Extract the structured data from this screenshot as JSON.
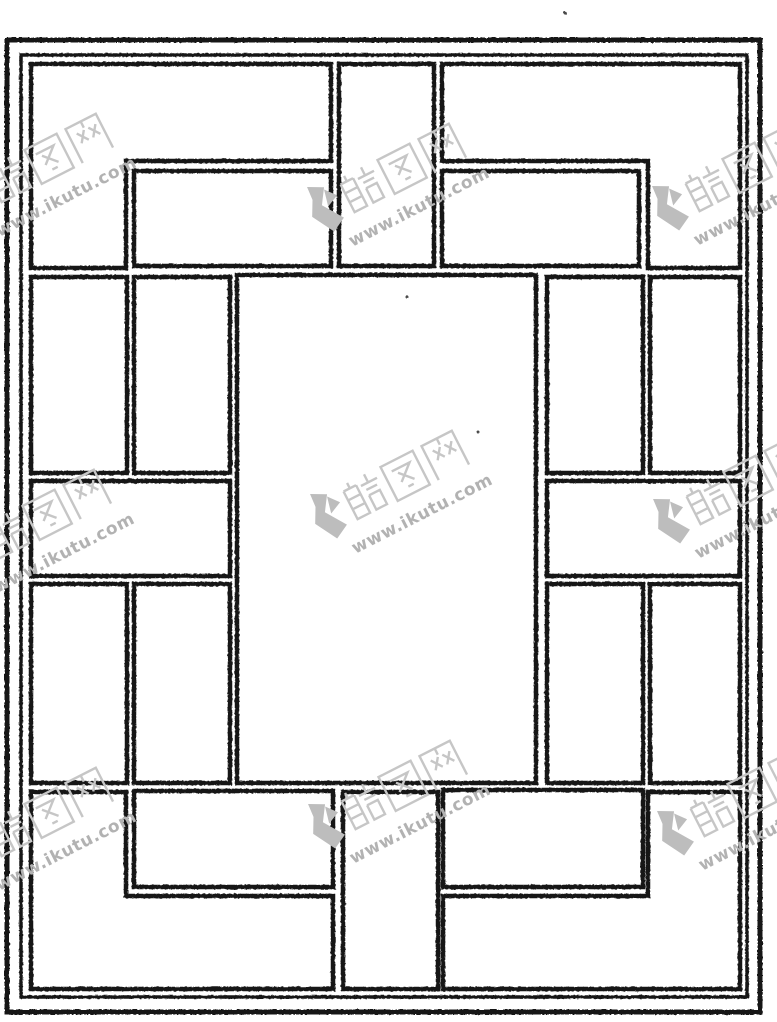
{
  "image": {
    "kind": "scanned line drawing of a traditional Chinese lattice window grille pattern",
    "width": 777,
    "height": 1022,
    "background_color": "#ffffff",
    "ink_color": "#191919"
  },
  "drawing": {
    "panel_stroke": 4.5,
    "borders": [
      {
        "x": 7,
        "y": 40,
        "w": 753,
        "h": 972,
        "stroke": 5
      },
      {
        "x": 21,
        "y": 55,
        "w": 726,
        "h": 942,
        "stroke": 3.5
      }
    ],
    "panels": [
      {
        "x": 134,
        "y": 171,
        "w": 197,
        "h": 95
      },
      {
        "x": 339,
        "y": 64,
        "w": 95,
        "h": 202
      },
      {
        "x": 442,
        "y": 171,
        "w": 197,
        "h": 95
      },
      {
        "x": 31,
        "y": 277,
        "w": 96,
        "h": 196
      },
      {
        "x": 134,
        "y": 277,
        "w": 96,
        "h": 196
      },
      {
        "x": 31,
        "y": 481,
        "w": 199,
        "h": 95
      },
      {
        "x": 31,
        "y": 584,
        "w": 96,
        "h": 199
      },
      {
        "x": 134,
        "y": 584,
        "w": 96,
        "h": 199
      },
      {
        "x": 237,
        "y": 275,
        "w": 299,
        "h": 508
      },
      {
        "x": 547,
        "y": 277,
        "w": 96,
        "h": 196
      },
      {
        "x": 650,
        "y": 277,
        "w": 90,
        "h": 196
      },
      {
        "x": 547,
        "y": 481,
        "w": 193,
        "h": 95
      },
      {
        "x": 547,
        "y": 584,
        "w": 96,
        "h": 199
      },
      {
        "x": 650,
        "y": 584,
        "w": 90,
        "h": 199
      },
      {
        "x": 134,
        "y": 791,
        "w": 199,
        "h": 96
      },
      {
        "x": 343,
        "y": 792,
        "w": 95,
        "h": 197
      },
      {
        "x": 443,
        "y": 790,
        "w": 200,
        "h": 97
      }
    ],
    "l_panels": [
      [
        [
          31,
          64
        ],
        [
          331,
          64
        ],
        [
          331,
          161
        ],
        [
          126,
          161
        ],
        [
          126,
          268
        ],
        [
          31,
          268
        ]
      ],
      [
        [
          442,
          64
        ],
        [
          740,
          64
        ],
        [
          740,
          268
        ],
        [
          648,
          268
        ],
        [
          648,
          161
        ],
        [
          442,
          161
        ]
      ],
      [
        [
          31,
          792
        ],
        [
          126,
          792
        ],
        [
          126,
          896
        ],
        [
          333,
          896
        ],
        [
          333,
          989
        ],
        [
          31,
          989
        ]
      ],
      [
        [
          740,
          792
        ],
        [
          648,
          792
        ],
        [
          648,
          896
        ],
        [
          443,
          896
        ],
        [
          443,
          989
        ],
        [
          740,
          989
        ]
      ]
    ],
    "specks": [
      [
        565,
        13
      ],
      [
        407,
        297
      ],
      [
        478,
        432
      ]
    ]
  },
  "watermark": {
    "brand_glyphs": "酷图网",
    "url": "www.ikutu.com",
    "rotation_deg": -27,
    "stamp_color": "#c6c6c6",
    "url_color": "#b2b2b2",
    "logo_color": "#bdbdbd",
    "instances": [
      {
        "x": -58,
        "y": 182
      },
      {
        "x": 295,
        "y": 192
      },
      {
        "x": 640,
        "y": 191
      },
      {
        "x": -60,
        "y": 538
      },
      {
        "x": 298,
        "y": 499
      },
      {
        "x": 641,
        "y": 504
      },
      {
        "x": -58,
        "y": 836
      },
      {
        "x": 296,
        "y": 809
      },
      {
        "x": 645,
        "y": 816
      }
    ]
  }
}
